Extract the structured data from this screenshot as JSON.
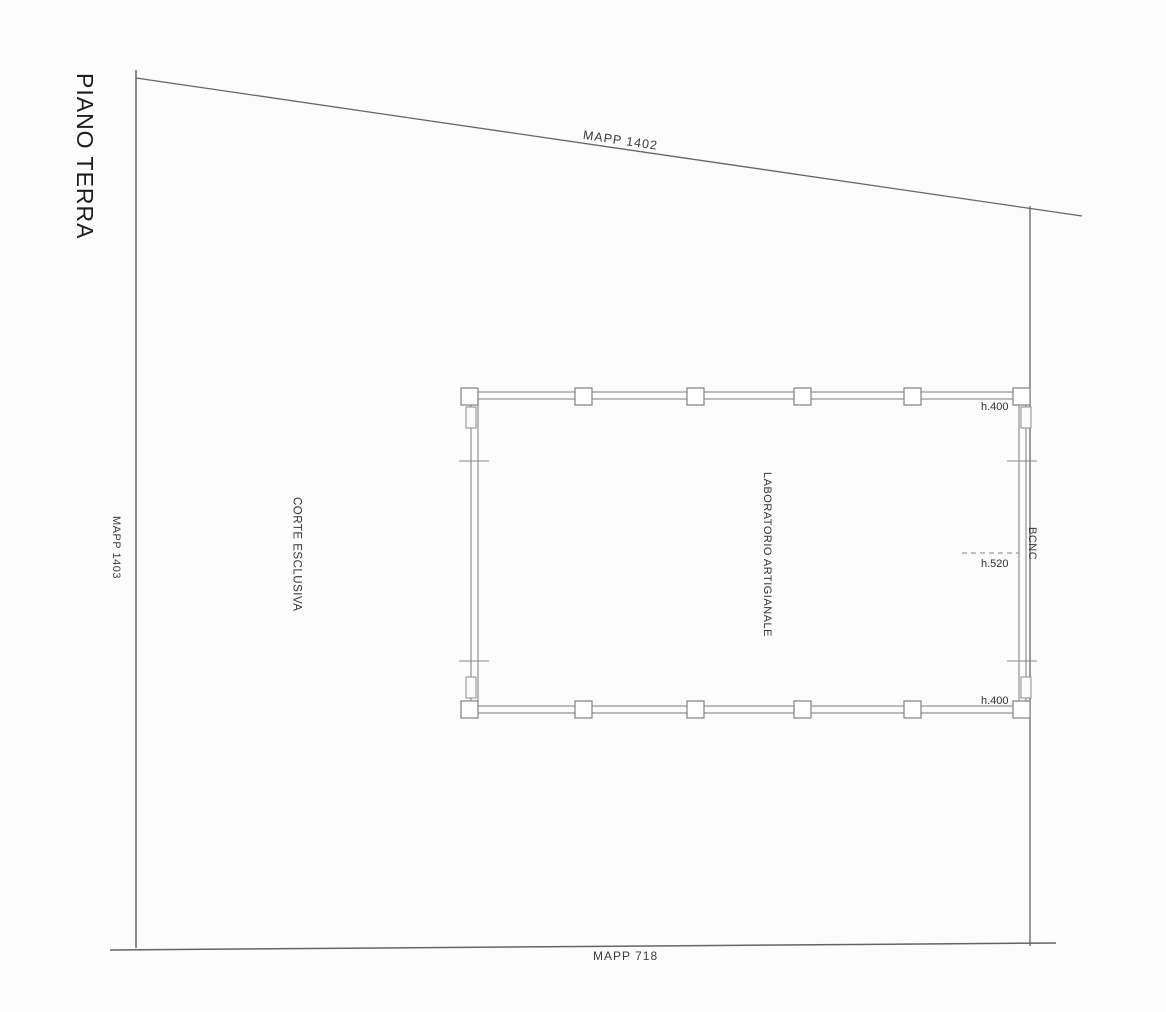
{
  "drawing": {
    "title": "PIANO TERRA",
    "parcels": {
      "top": "MAPP 1402",
      "left": "MAPP 1403",
      "bottom": "MAPP 718"
    },
    "areas": {
      "courtyard": "CORTE ESCLUSIVA",
      "workshop": "LABORATORIO ARTIGIANALE",
      "bcnc": "BCNC"
    },
    "dimensions": {
      "height_top_right": "h.400",
      "height_mid_right": "h.520",
      "height_bottom_right": "h.400"
    },
    "colors": {
      "background": "#fcfcfc",
      "boundary_line": "#646464",
      "wall_line": "#7d7d7d",
      "text": "#2b2b2b"
    }
  }
}
